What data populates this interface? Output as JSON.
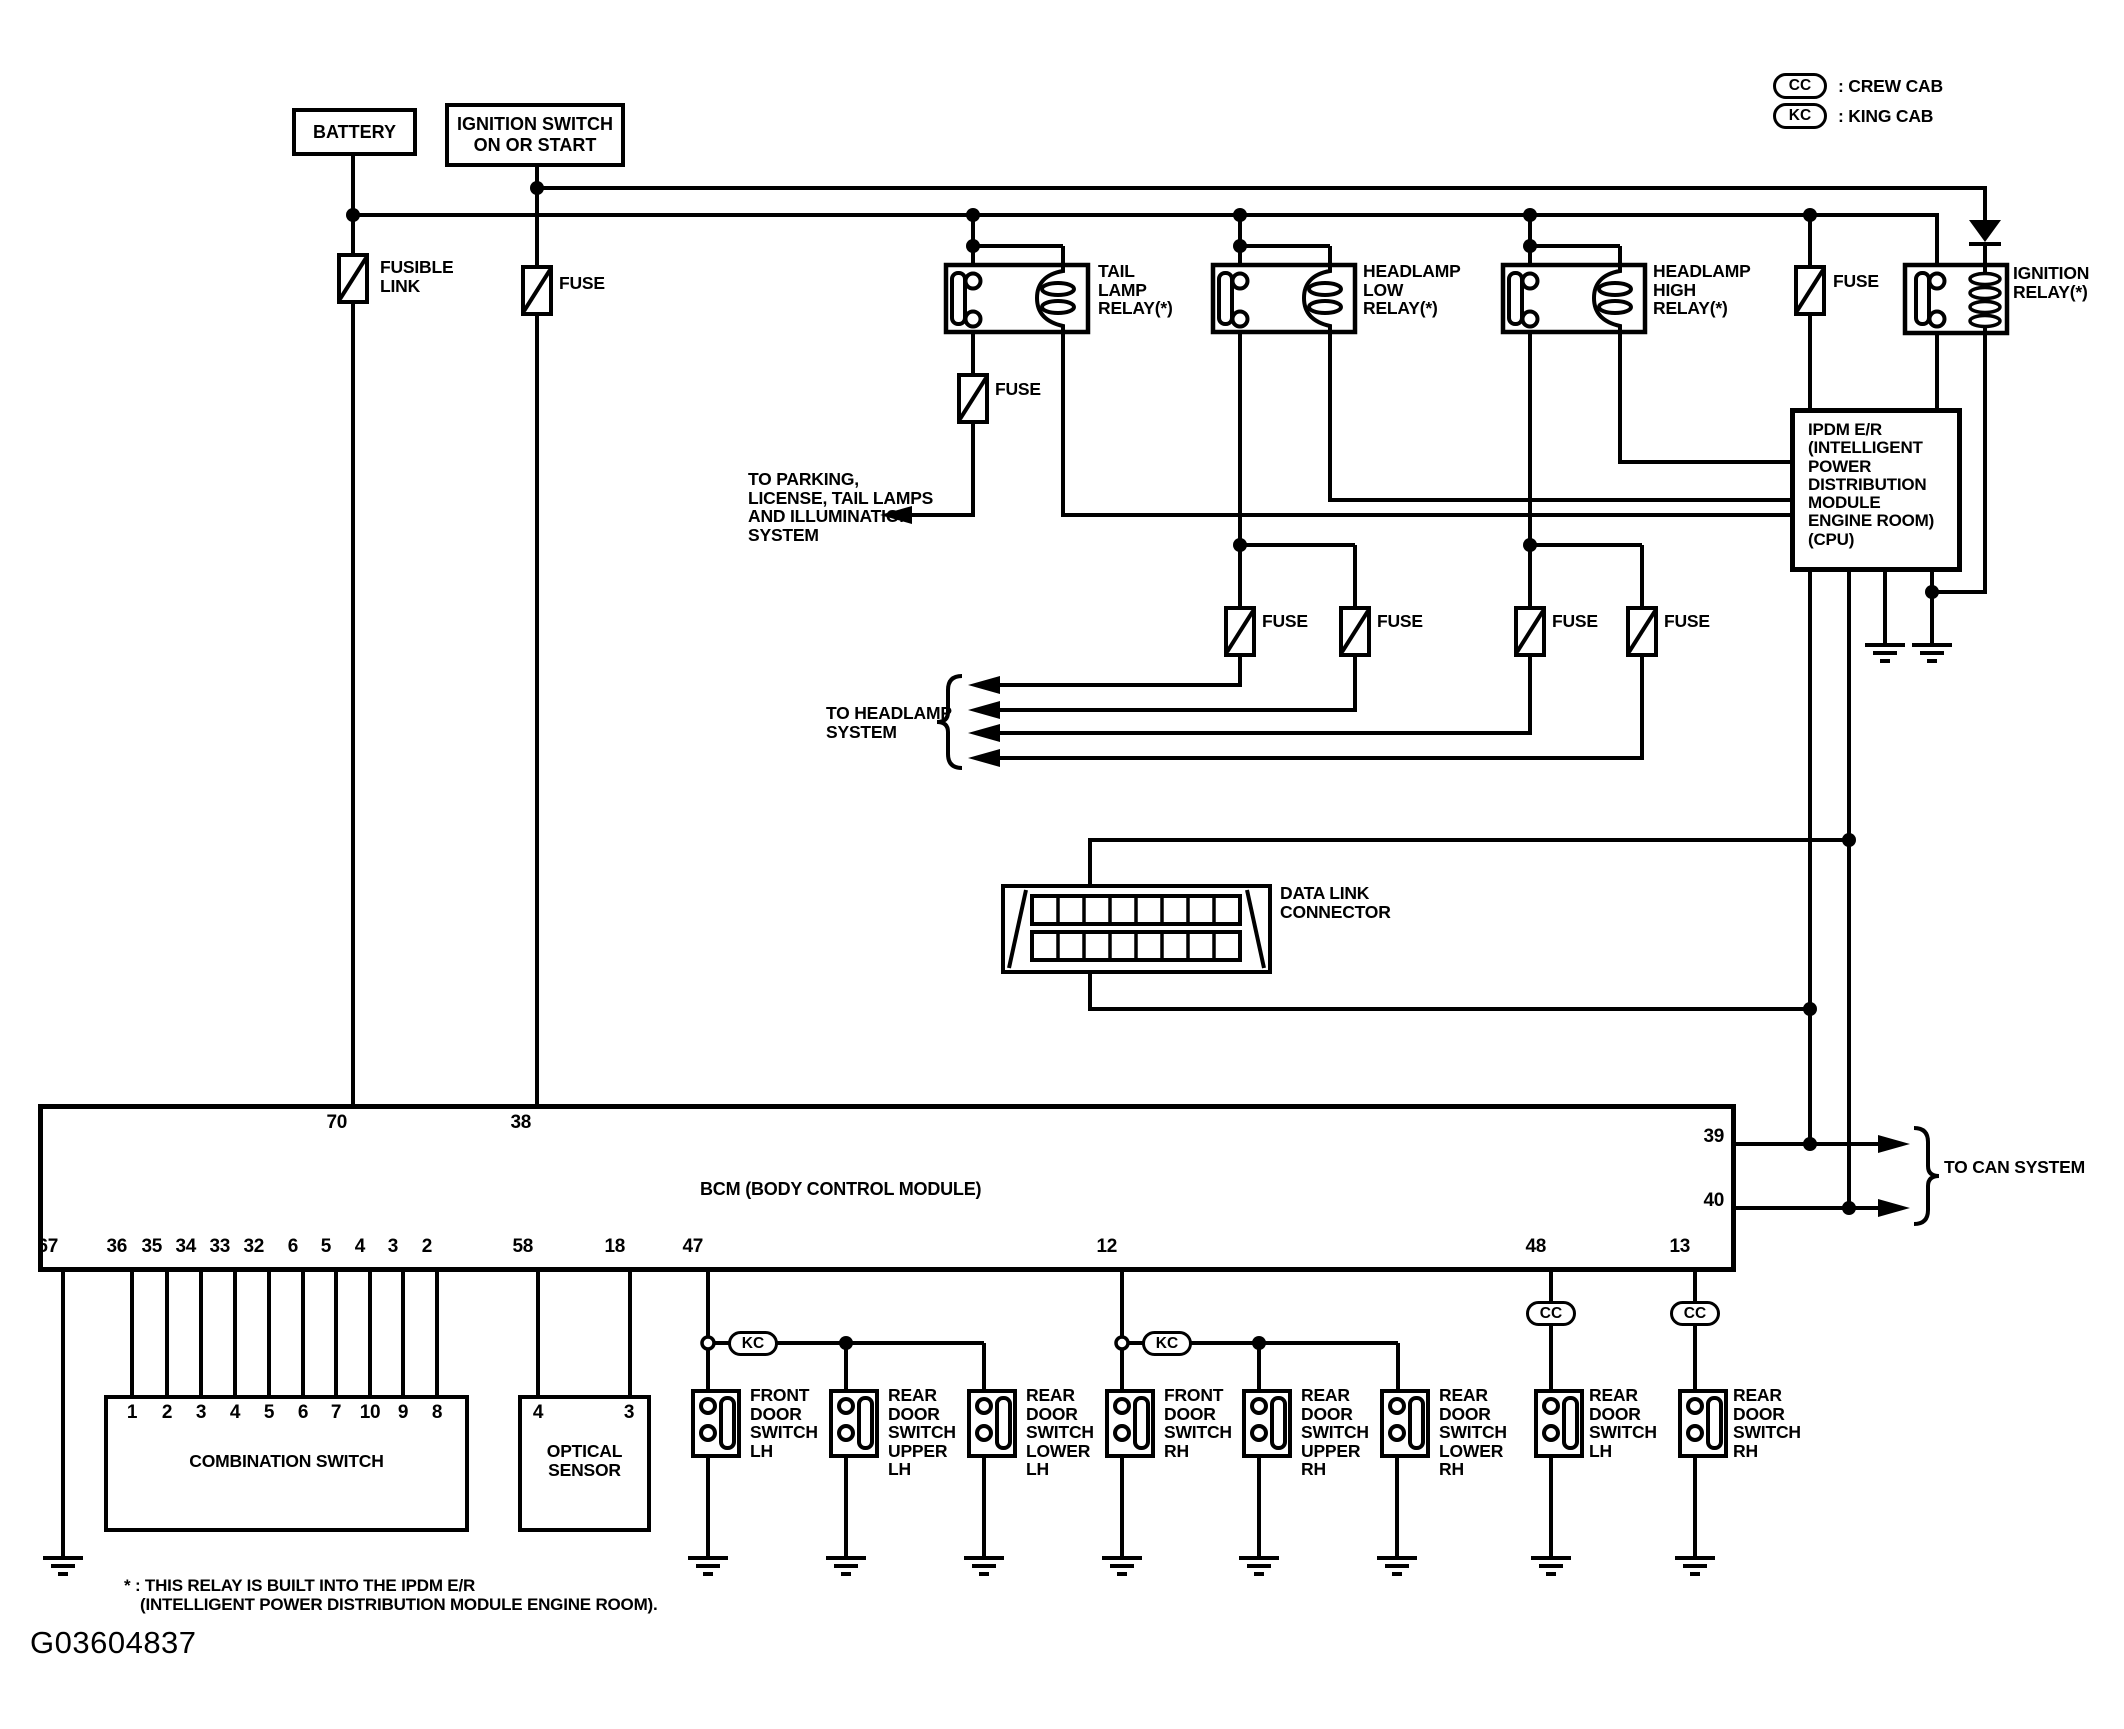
{
  "legend": {
    "cc_desc": ": CREW CAB",
    "kc_desc": ": KING CAB"
  },
  "boxes": {
    "battery": "BATTERY",
    "ignition_switch": "IGNITION SWITCH\nON OR START",
    "ipdm": "IPDM E/R\n(INTELLIGENT\nPOWER\nDISTRIBUTION\nMODULE\nENGINE ROOM)\n(CPU)",
    "bcm": "BCM (BODY CONTROL MODULE)",
    "combination_switch": "COMBINATION SWITCH",
    "optical_sensor": "OPTICAL\nSENSOR",
    "data_link_connector": "DATA LINK\nCONNECTOR"
  },
  "labels": {
    "fusible_link": "FUSIBLE\nLINK",
    "fuse": "FUSE",
    "tail_lamp_relay": "TAIL\nLAMP\nRELAY(*)",
    "headlamp_low_relay": "HEADLAMP\nLOW\nRELAY(*)",
    "headlamp_high_relay": "HEADLAMP\nHIGH\nRELAY(*)",
    "ignition_relay": "IGNITION\nRELAY(*)",
    "to_parking": "TO PARKING,\nLICENSE, TAIL LAMPS\nAND ILLUMINATION\nSYSTEM",
    "to_headlamp": "TO HEADLAMP\nSYSTEM",
    "to_can": "TO CAN SYSTEM",
    "kc": "KC",
    "cc": "CC"
  },
  "bcm_pins": {
    "top": [
      "70",
      "38"
    ],
    "right": [
      "39",
      "40"
    ],
    "bottom": [
      "67",
      "36",
      "35",
      "34",
      "33",
      "32",
      "6",
      "5",
      "4",
      "3",
      "2",
      "58",
      "18",
      "47",
      "12",
      "48",
      "13"
    ]
  },
  "combination_switch_pins": [
    "1",
    "2",
    "3",
    "4",
    "5",
    "6",
    "7",
    "10",
    "9",
    "8"
  ],
  "optical_sensor_pins": [
    "4",
    "3"
  ],
  "door_switches": [
    "FRONT\nDOOR\nSWITCH\nLH",
    "REAR\nDOOR\nSWITCH\nUPPER\nLH",
    "REAR\nDOOR\nSWITCH\nLOWER\nLH",
    "FRONT\nDOOR\nSWITCH\nRH",
    "REAR\nDOOR\nSWITCH\nUPPER\nRH",
    "REAR\nDOOR\nSWITCH\nLOWER\nRH",
    "REAR\nDOOR\nSWITCH\nLH",
    "REAR\nDOOR\nSWITCH\nRH"
  ],
  "footnote": {
    "line1": "* : THIS RELAY IS BUILT INTO THE IPDM E/R",
    "line2": "(INTELLIGENT POWER DISTRIBUTION MODULE ENGINE ROOM)."
  },
  "figure_id": "G03604837",
  "colors": {
    "line": "#000000",
    "background": "#ffffff"
  }
}
